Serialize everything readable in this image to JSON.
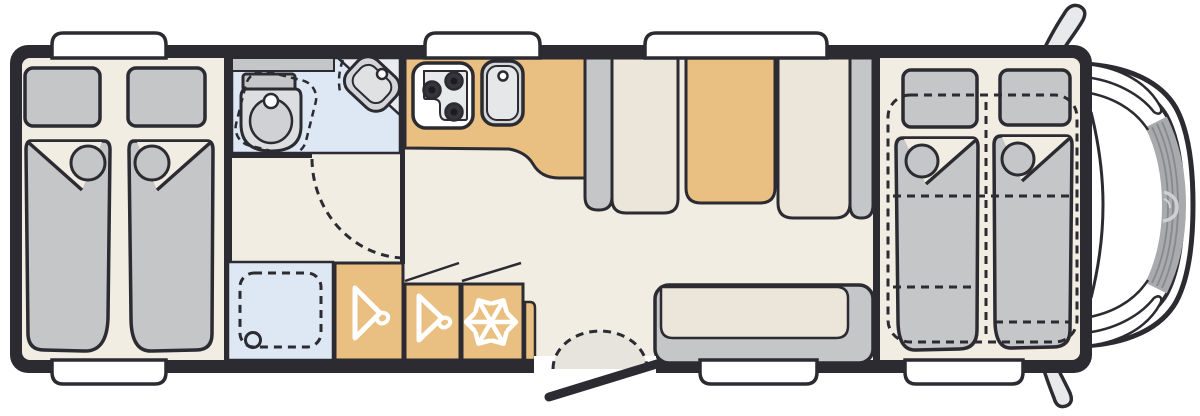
{
  "diagram": {
    "type": "motorhome-floor-plan",
    "view": "top-down",
    "orientation": "cab-front-right, rear-left"
  },
  "colors": {
    "page": "#ffffff",
    "body": "#2b2b31",
    "outline": "#2b2b31",
    "floor": "#f2ede3",
    "wet_room": "#dde8f4",
    "furniture_tan": "#eabf82",
    "soft_gray": "#c5c6c8",
    "cushion_beige": "#ece5da",
    "appliance_gray": "#dcdee0",
    "step_gray": "#e7e4de",
    "cab_glass_band": "#a8aaad",
    "icon_white": "#ffffff"
  },
  "zones": [
    {
      "name": "rear-bedroom",
      "furniture": [
        "twin-bed",
        "twin-bed"
      ],
      "pillows": 2
    },
    {
      "name": "washroom",
      "furniture": [
        "swivel-toilet",
        "corner-washbasin",
        "vanity-counter"
      ]
    },
    {
      "name": "shower",
      "features": [
        "dashed-tray",
        "drain"
      ]
    },
    {
      "name": "kitchen",
      "furniture": [
        "hob-3-burner",
        "kitchen-sink",
        "worktop"
      ]
    },
    {
      "name": "wardrobe-row",
      "icons": [
        "hanger-icon",
        "hanger-icon",
        "snowflake-icon"
      ]
    },
    {
      "name": "dinette",
      "furniture": [
        "bench-seat",
        "table",
        "bench-seat"
      ]
    },
    {
      "name": "lounge",
      "furniture": [
        "side-sofa"
      ]
    },
    {
      "name": "entrance",
      "features": [
        "open-door",
        "entry-step"
      ]
    },
    {
      "name": "front-bedroom",
      "furniture": [
        "drop-down-bed",
        "drop-down-bed"
      ],
      "style": "dashed-outline"
    },
    {
      "name": "cab",
      "features": [
        "windshield",
        "mirror",
        "mirror",
        "brand-swirl"
      ]
    }
  ],
  "windows": {
    "top_count": 3,
    "bottom_count": 3
  }
}
